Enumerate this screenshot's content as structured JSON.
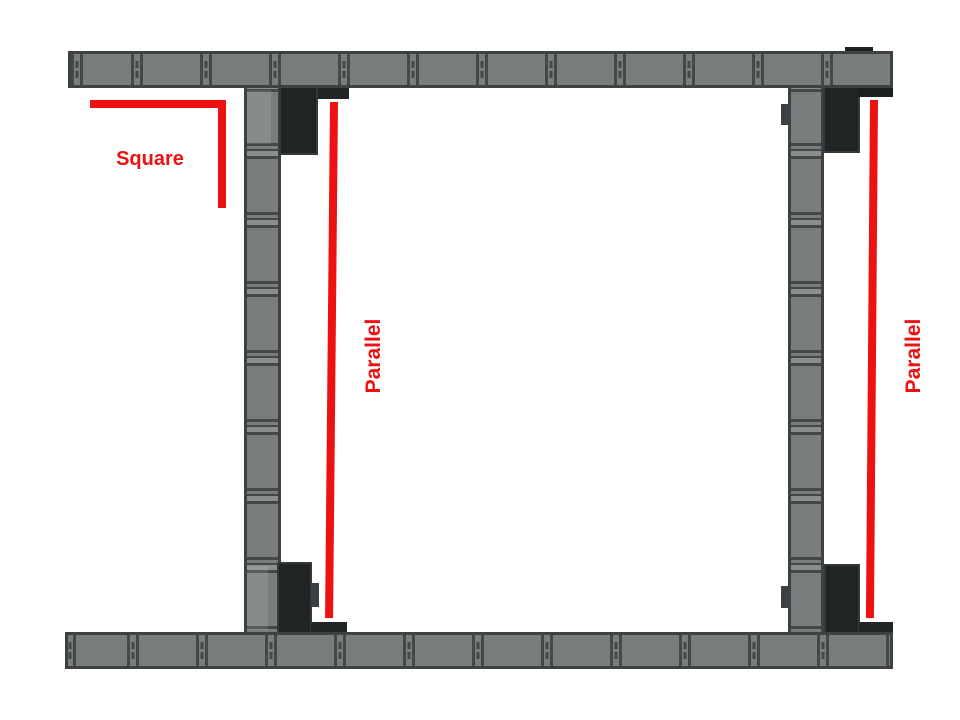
{
  "diagram": {
    "type": "assembly-annotation",
    "labels": {
      "square": "Square",
      "parallel_left": "Parallel",
      "parallel_right": "Parallel"
    },
    "colors": {
      "annotation_red": "#ee1111",
      "rail_gray": "#7a7d7d",
      "rail_edge": "#3e4141",
      "divider": "#454848",
      "gusset_black": "#212425",
      "background": "#ffffff"
    }
  }
}
